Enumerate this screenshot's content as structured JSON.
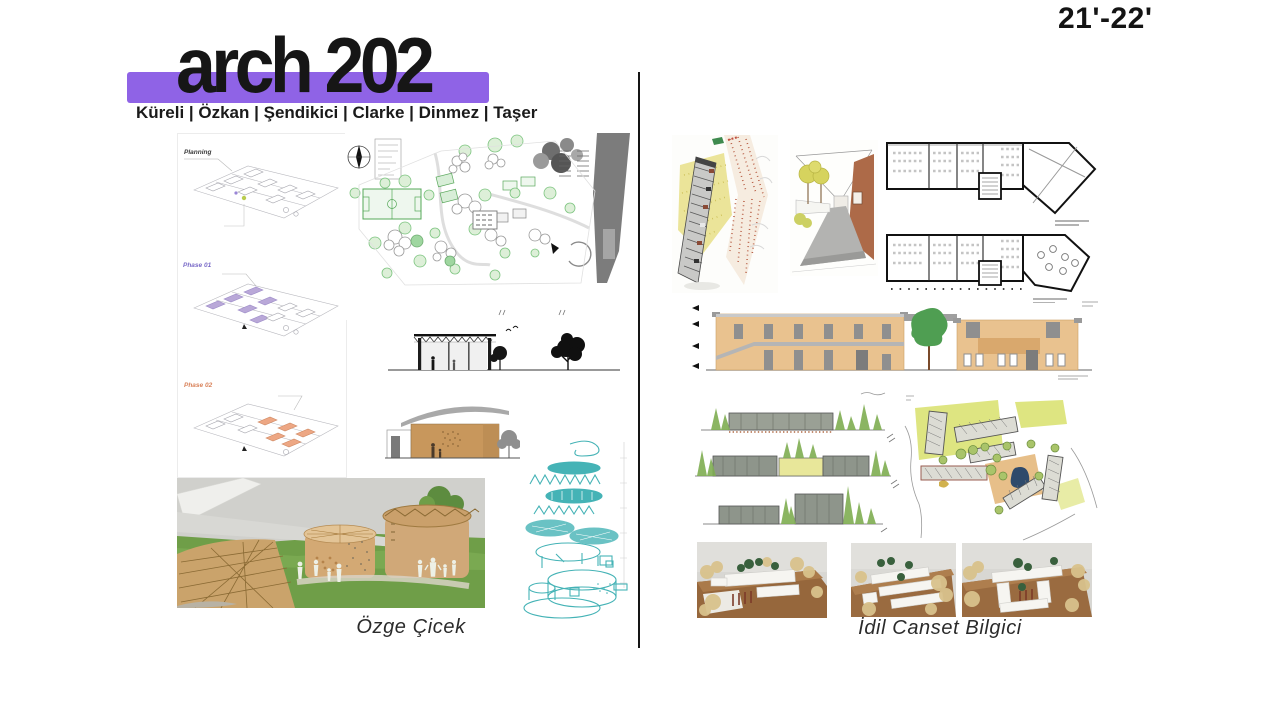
{
  "slide": {
    "year_label": "21'-22'",
    "header": {
      "course_title": "arch 202",
      "instructors": "Küreli |  Özkan | Şendikici |  Clarke |  Dinmez |  Taşer"
    },
    "left_panel": {
      "student_name": "Özge Çicek",
      "phase_labels": {
        "planning": "Planning",
        "phase1": "Phase 01",
        "phase2": "Phase 02"
      }
    },
    "right_panel": {
      "student_name": "İdil Canset Bilgici"
    },
    "colors": {
      "accent_purple": "#8f63e6",
      "teal": "#45b3b6",
      "tan": "#e9c28f",
      "tree_green": "#4f9e52",
      "divider_black": "#151515"
    }
  }
}
